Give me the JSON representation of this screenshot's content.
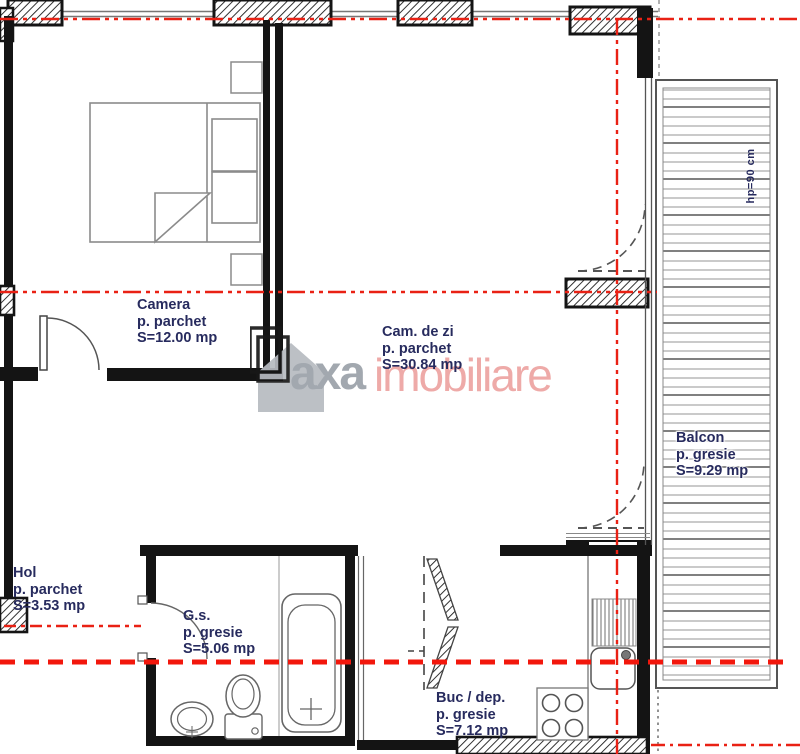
{
  "plan": {
    "rooms": [
      {
        "id": "camera",
        "name": "Camera",
        "floor": "p. parchet",
        "area": "S=12.00 mp"
      },
      {
        "id": "cam_de_zi",
        "name": "Cam. de zi",
        "floor": "p. parchet",
        "area": "S=30.84 mp"
      },
      {
        "id": "balcon",
        "name": "Balcon",
        "floor": "p. gresie",
        "area": "S=9.29 mp"
      },
      {
        "id": "hol",
        "name": "Hol",
        "floor": "p. parchet",
        "area": "S=3.53 mp"
      },
      {
        "id": "gs",
        "name": "G.s.",
        "floor": "p. gresie",
        "area": "S=5.06 mp"
      },
      {
        "id": "buc",
        "name": "Buc / dep.",
        "floor": "p. gresie",
        "area": "S=7.12 mp"
      }
    ],
    "annotations": {
      "balcony_parapet": "hp=90 cm"
    },
    "watermark": {
      "brand": "axa",
      "suffix": "imobiliare"
    },
    "colors": {
      "wall": "#141414",
      "section_line": "#e92114",
      "section_line_thick": "#f2170c",
      "label_text": "#272b5e",
      "watermark_gray": "#9ba1a9",
      "watermark_pink": "#eda3a1"
    }
  }
}
